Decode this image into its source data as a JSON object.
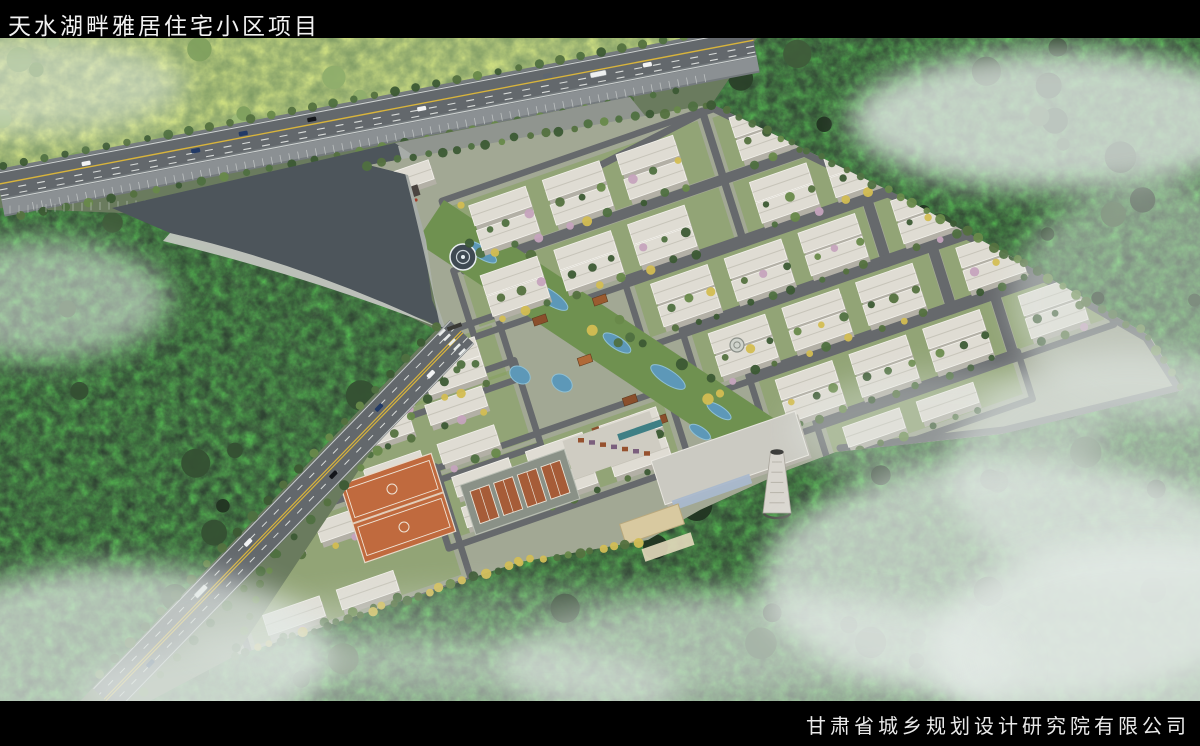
{
  "header": {
    "title": "天水湖畔雅居住宅小区项目"
  },
  "footer": {
    "company": "甘肃省城乡规划设计研究院有限公司"
  },
  "scene": {
    "features": [
      "perimeter highway",
      "entrance lake plaza",
      "main access road",
      "residential building rows",
      "central landscape axis with pools",
      "fountain plaza",
      "basketball courts",
      "tennis courts",
      "community center",
      "boiler chimney",
      "hedge maze courtyard",
      "forest hills",
      "morning fog"
    ],
    "colors": {
      "bar_black": "#000000",
      "title_text": "#f2f2f2",
      "forest_dark": "#2c4130",
      "hills_green": "#7e9b63",
      "lawn_green": "#7e9a58",
      "road_asphalt": "#6d7276",
      "lane_yellow": "#d8b43c",
      "building_white": "#dfdcd3",
      "water_blue": "#5d98b8",
      "lake_gray": "#4d555b",
      "court_orange": "#c06a3e",
      "roof_brown": "#96512e",
      "autumn_yellow": "#d3bd52",
      "fog_white": "#e3eae6"
    }
  }
}
